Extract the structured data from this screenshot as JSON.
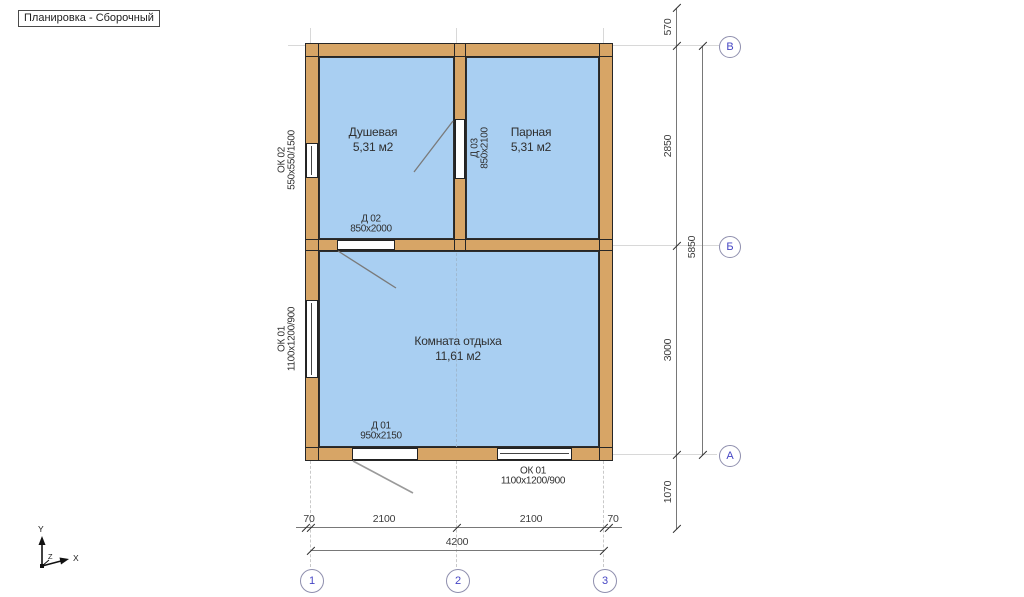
{
  "viewport": {
    "label": "Планировка - Сборочный"
  },
  "rooms": [
    {
      "name": "Душевая",
      "area": "5,31 м2"
    },
    {
      "name": "Парная",
      "area": "5,31 м2"
    },
    {
      "name": "Комната отдыха",
      "area": "11,61 м2"
    }
  ],
  "openings": {
    "ok02": {
      "label": "ОК 02",
      "size": "550х550/1500"
    },
    "ok01_left": {
      "label": "ОК 01",
      "size": "1100х1200/900"
    },
    "ok01_bottom": {
      "label": "ОК 01",
      "size": "1100х1200/900"
    },
    "d01": {
      "label": "Д 01",
      "size": "950х2150"
    },
    "d02": {
      "label": "Д 02",
      "size": "850х2000"
    },
    "d03": {
      "label": "Д 03",
      "size": "850х2100"
    }
  },
  "dimensions": {
    "right": [
      "570",
      "2850",
      "3000",
      "1070"
    ],
    "right_total": "5850",
    "bottom": [
      "70",
      "2100",
      "2100",
      "70"
    ],
    "bottom_total": "4200"
  },
  "axes_vertical": [
    "В",
    "Б",
    "А"
  ],
  "axes_horizontal": [
    "1",
    "2",
    "3"
  ],
  "triad": {
    "x": "X",
    "y": "Y",
    "z": "Z"
  },
  "colors": {
    "wall": "#d7a566",
    "room_fill": "#a9cff2",
    "outline": "#262626",
    "axis_text": "#4545c4",
    "axis_circle_border": "#8f8fae",
    "dimension_text": "#3d3d3d",
    "grid_line": "#d8d8d8"
  }
}
